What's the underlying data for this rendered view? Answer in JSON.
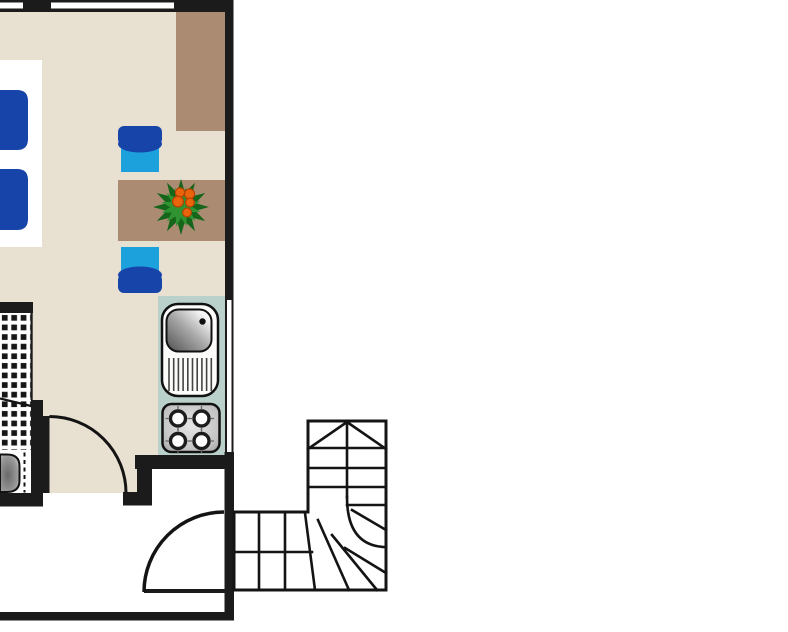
{
  "plan": {
    "kind": "apartment floor plan, top view, no text labels",
    "objects": {
      "bed": "double bed with two blue duvets (cut by left edge)",
      "wardrobe": "tall brown cupboard in top-right corner",
      "table": "brown dining table against right wall",
      "plant": "green potted plant with orange flowers on table",
      "chair_top": "blue chair above table",
      "chair_bottom": "blue chair below table",
      "kitchenette": "kitchen counter strip on right wall",
      "sink": "stainless sink with drainboard",
      "cooktop": "4-burner cooktop",
      "tiled_area": "checker-tiled bathroom floor (cut by left edge)",
      "toilet": "white fixture in bathroom niche",
      "curtain": "dashed screen line beside fixture",
      "interior_door": "interior door with quarter-circle swing arc",
      "entrance_door": "entrance door with quarter-circle swing arc",
      "staircase": "L-shaped winder staircase with up-direction chevron",
      "windows": "white window openings in top and right walls"
    }
  },
  "colors": {
    "bg": "#ffffff",
    "wall": "#1b1b1b",
    "line": "#141414",
    "floor": "#e8e1d2",
    "wood": "#ac8b73",
    "counter": "#bad1cb",
    "seat": "#1da1dd",
    "blue": "#1644a8",
    "plant_dark": "#15651a",
    "plant_light": "#2f9331",
    "berry": "#e8650e",
    "berry_rim": "#b84100",
    "metal_dark": "#4f4f4f",
    "metal_mid": "#a8a8a8",
    "metal_light": "#f7f7f7",
    "fixture_white": "#fcfcfa"
  }
}
